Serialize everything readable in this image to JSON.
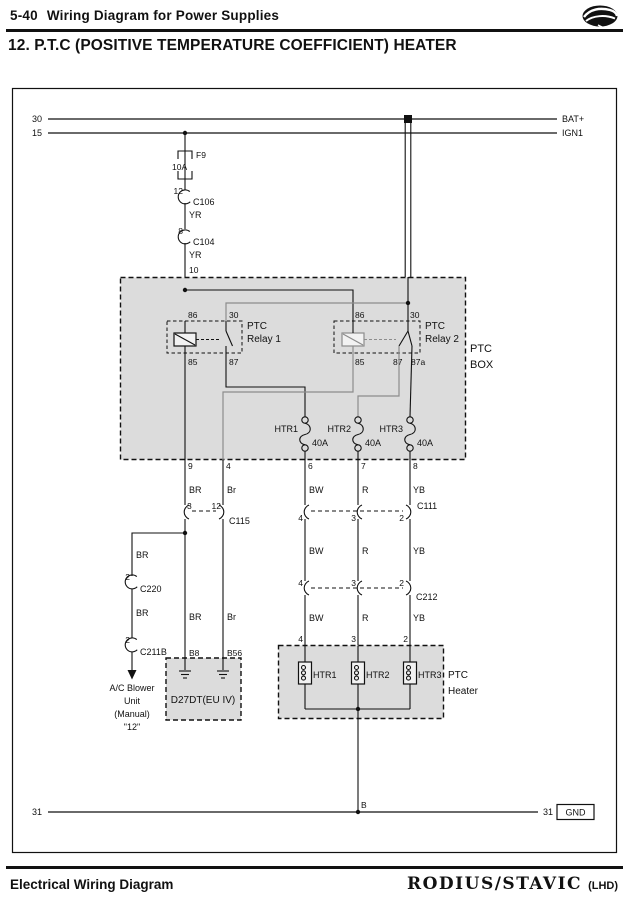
{
  "page": {
    "header": {
      "section": "5-40",
      "section_title": "Wiring Diagram for Power Supplies"
    },
    "title": "12. P.T.C (POSITIVE TEMPERATURE COEFFICIENT) HEATER",
    "footer": {
      "label": "Electrical Wiring Diagram",
      "brand": "RODIUS/STAVIC",
      "variant": "(LHD)"
    }
  },
  "colors": {
    "wire_black": "#111111",
    "wire_gray": "#8c8c8c",
    "box_fill": "#dcdcdc"
  },
  "d": {
    "r30": "30",
    "bat": "BAT+",
    "r15": "15",
    "ign": "IGN1",
    "f9": {
      "name": "F9",
      "rating": "10A"
    },
    "c106": {
      "pin": "12",
      "name": "C106",
      "wire": "YR"
    },
    "c104": {
      "pin": "8",
      "name": "C104",
      "wire": "YR"
    },
    "pin10": "10",
    "box": {
      "l1": "PTC",
      "l2": "BOX"
    },
    "relay1": {
      "p86": "86",
      "p30": "30",
      "p85": "85",
      "p87": "87",
      "n1": "PTC",
      "n2": "Relay 1"
    },
    "relay2": {
      "p86": "86",
      "p30": "30",
      "p85": "85",
      "p87": "87",
      "p87a": "87a",
      "n1": "PTC",
      "n2": "Relay 2"
    },
    "htr_fuses": [
      {
        "name": "HTR1",
        "rating": "40A"
      },
      {
        "name": "HTR2",
        "rating": "40A"
      },
      {
        "name": "HTR3",
        "rating": "40A"
      }
    ],
    "out_pins": [
      "9",
      "4",
      "6",
      "7",
      "8"
    ],
    "colors1": [
      "BR",
      "Br",
      "BW",
      "R",
      "YB"
    ],
    "c115": {
      "p1": "3",
      "p2": "12",
      "name": "C115"
    },
    "c111": {
      "p1": "4",
      "p2": "3",
      "p3": "2",
      "name": "C111"
    },
    "branch": {
      "w1": "BR",
      "c220_pin": "2",
      "c220": "C220",
      "w2": "BR",
      "c211b_pin": "2",
      "c211b": "C211B",
      "dest": [
        "A/C Blower",
        "Unit",
        "(Manual)",
        "\"12\""
      ]
    },
    "ecu": {
      "w1": "BR",
      "w2": "Br",
      "pin1": "B8",
      "pin2": "B56",
      "name": "D27DT(EU IV)"
    },
    "colors2": [
      "BW",
      "R",
      "YB"
    ],
    "c212": {
      "p1": "4",
      "p2": "3",
      "p3": "2",
      "name": "C212"
    },
    "colors3": [
      "BW",
      "R",
      "YB"
    ],
    "heater": {
      "pins": [
        "4",
        "3",
        "2"
      ],
      "el": [
        "HTR1",
        "HTR2",
        "HTR3"
      ],
      "l1": "PTC",
      "l2": "Heater"
    },
    "gnd": {
      "pinb": "B",
      "l": "31",
      "r": "31",
      "box": "GND"
    }
  }
}
